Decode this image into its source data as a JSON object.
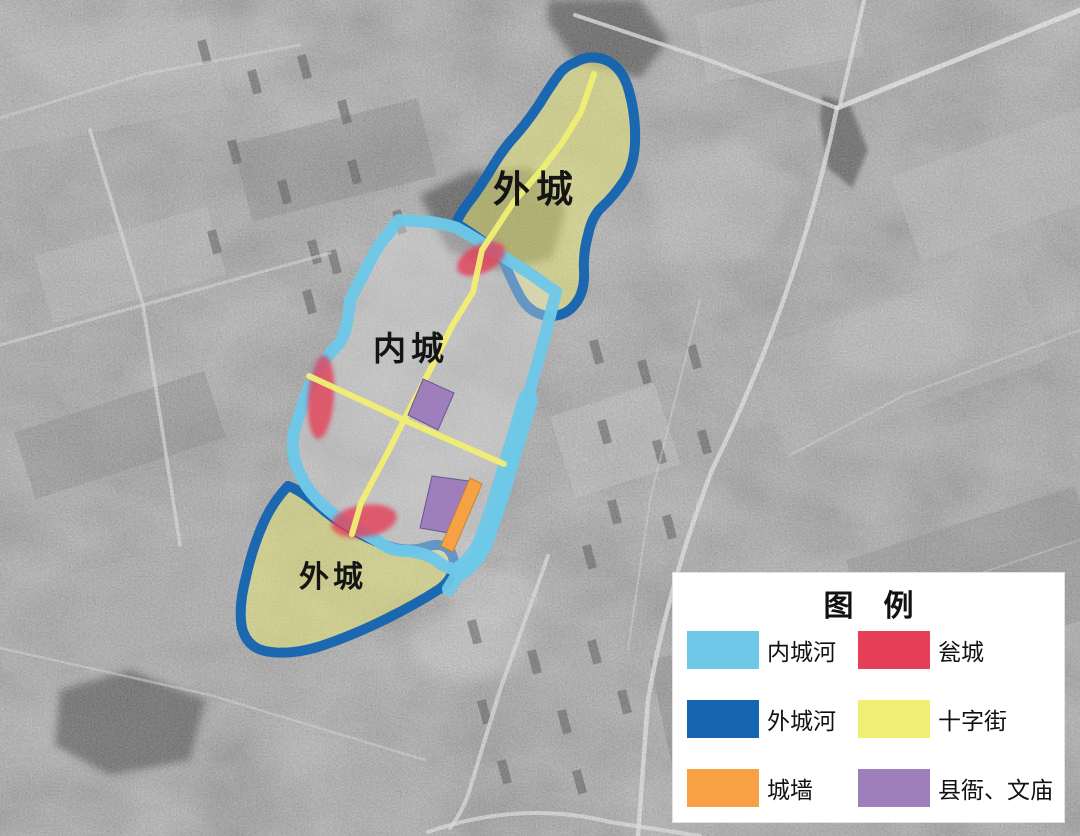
{
  "map": {
    "region_labels": [
      {
        "id": "outer-city-north",
        "text": "外城"
      },
      {
        "id": "inner-city",
        "text": "内城"
      },
      {
        "id": "outer-city-south",
        "text": "外城"
      }
    ]
  },
  "legend": {
    "title": "图　例",
    "items": [
      {
        "id": "inner-moat",
        "label": "内城河",
        "color": "#6FC8E8"
      },
      {
        "id": "barbican",
        "label": "瓮城",
        "color": "#E63E56"
      },
      {
        "id": "outer-moat",
        "label": "外城河",
        "color": "#1565B0"
      },
      {
        "id": "cross-street",
        "label": "十字街",
        "color": "#F0EE73"
      },
      {
        "id": "city-wall",
        "label": "城墙",
        "color": "#F6A244"
      },
      {
        "id": "yamen-temple",
        "label": "县衙、文庙",
        "color": "#9E7FBC"
      }
    ]
  }
}
